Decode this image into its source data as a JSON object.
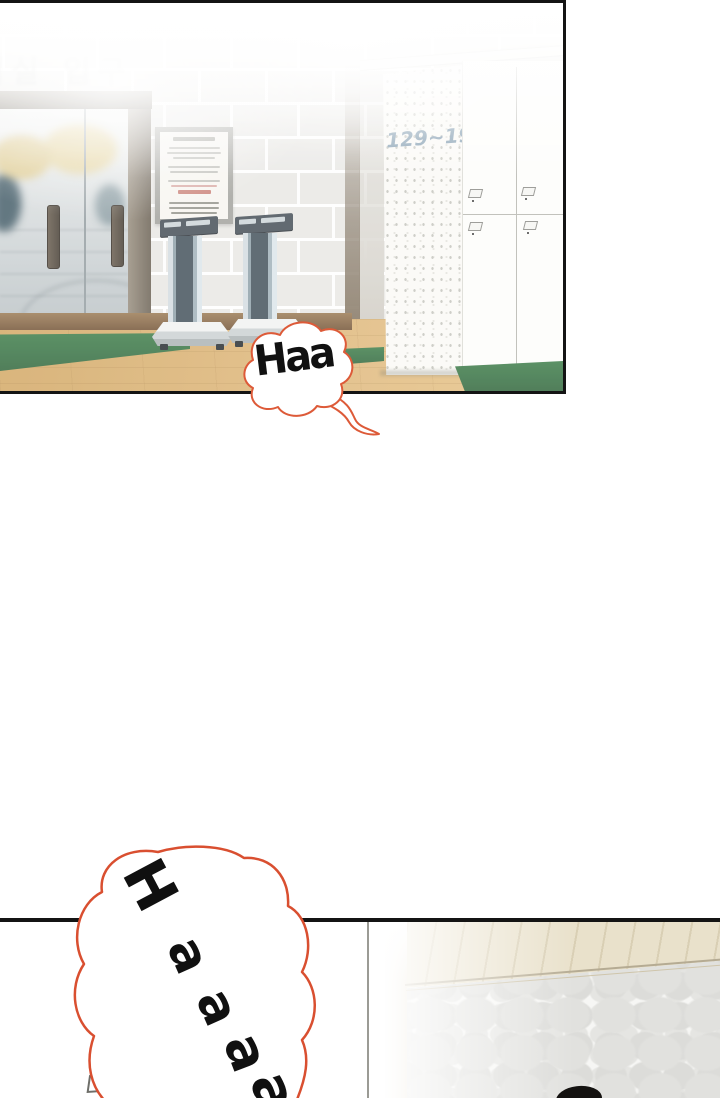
{
  "page": {
    "background": "#ffffff",
    "kind": "webtoon-comic-page"
  },
  "panel1": {
    "wall_sign": {
      "text": "탈의실 입구"
    },
    "speech_bubble": {
      "text": "Haa",
      "outline_color": "#dd5a38"
    },
    "locker_label": {
      "text": "129~193",
      "color": "#7e99ad"
    },
    "colors": {
      "mat_green": "#3f7b4b",
      "floor_wood": "#ddb77c",
      "brick_wall": "#e9e8e5",
      "panel_border": "#141414"
    }
  },
  "panel2": {
    "speech_bubble": {
      "text": "Haaaa",
      "letters": [
        "H",
        "a",
        "a",
        "a",
        "a"
      ],
      "outline_color": "#d94f30"
    },
    "colors": {
      "upper_band": "#e9e1cb",
      "pebble_wall": "#e1e1de"
    }
  }
}
